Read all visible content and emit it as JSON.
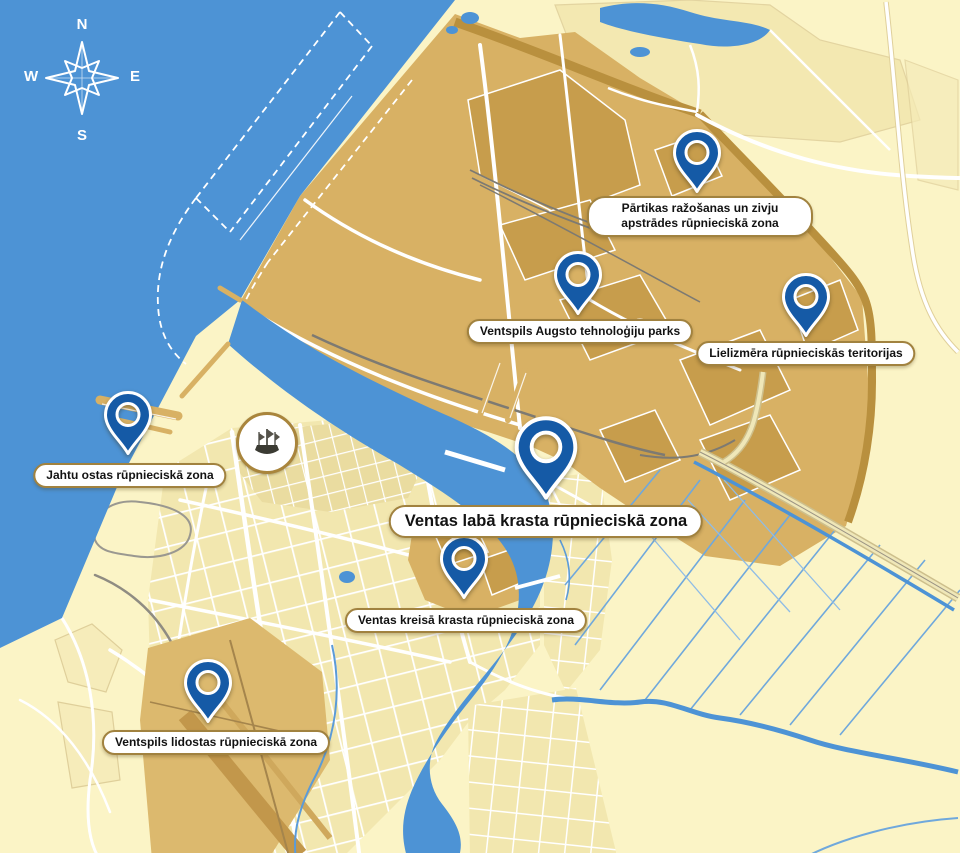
{
  "compass": {
    "n": "N",
    "e": "E",
    "s": "S",
    "w": "W"
  },
  "zones": [
    {
      "id": "food-and-fish-processing",
      "label": "Pārtikas ražošanas un zivju apstrādes rūpnieciskā zona"
    },
    {
      "id": "high-technology-park",
      "label": "Ventspils Augsto tehnoloģiju parks"
    },
    {
      "id": "large-scale-industrial",
      "label": "Lielizmēra rūpnieciskās teritorijas"
    },
    {
      "id": "yacht-port",
      "label": "Jahtu ostas rūpnieciskā zona"
    },
    {
      "id": "venta-right-bank",
      "label": "Ventas labā krasta rūpnieciskā zona",
      "primary": true
    },
    {
      "id": "venta-left-bank",
      "label": "Ventas kreisā krasta rūpnieciskā zona"
    },
    {
      "id": "airport-industrial",
      "label": "Ventspils lidostas rūpnieciskā zona"
    }
  ],
  "colors": {
    "sea": "#4D93D5",
    "land": "#FBF4C6",
    "industrial": "#D8B164",
    "industrial_dark": "#C2974B",
    "industrial_band": "#B9903E",
    "drainage_channel": "#6FA8DC",
    "pin": "#155AA6",
    "label_border": "#A1823F"
  }
}
